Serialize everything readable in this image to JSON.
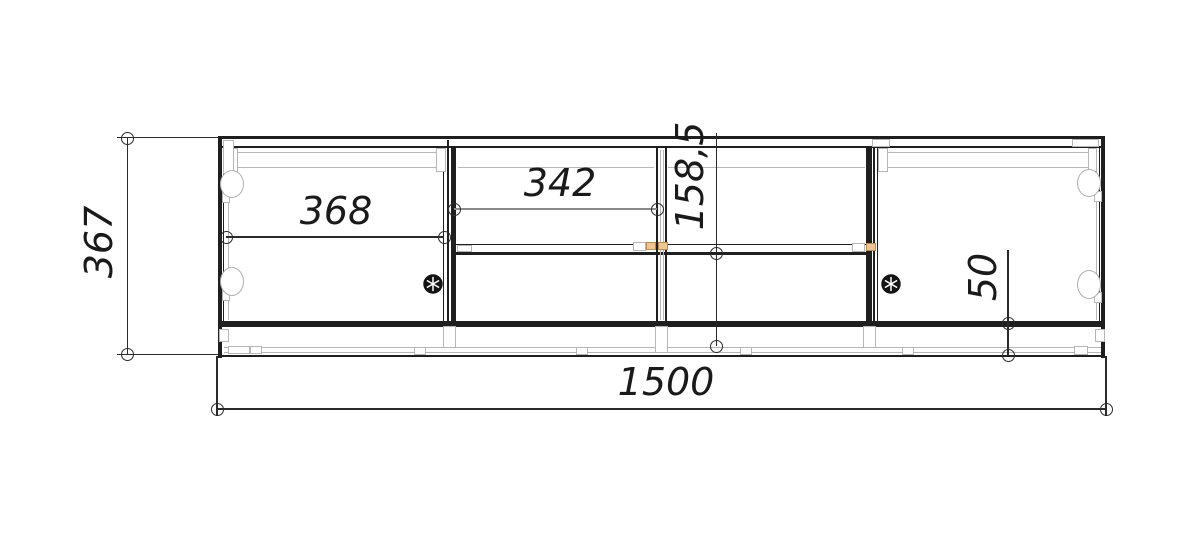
{
  "drawing": {
    "kind": "cabinet front-view technical drawing",
    "dimensions": {
      "overall_height": "367",
      "overall_width": "1500",
      "left_section_width": "368",
      "middle_opening_width": "342",
      "lower_opening_height": "158,5",
      "plinth_height": "50"
    },
    "icons": {
      "knob": "wheel-knob-icon",
      "hinge": "hinge-cup-icon",
      "dimension_end": "dimension-endpoint-circle"
    },
    "colors": {
      "line": "#1f1f1f",
      "dimension_line": "#2a2a2a",
      "construction_line": "#b6b6b6",
      "connector_highlight": "#ecc795",
      "background": "#ffffff"
    }
  }
}
